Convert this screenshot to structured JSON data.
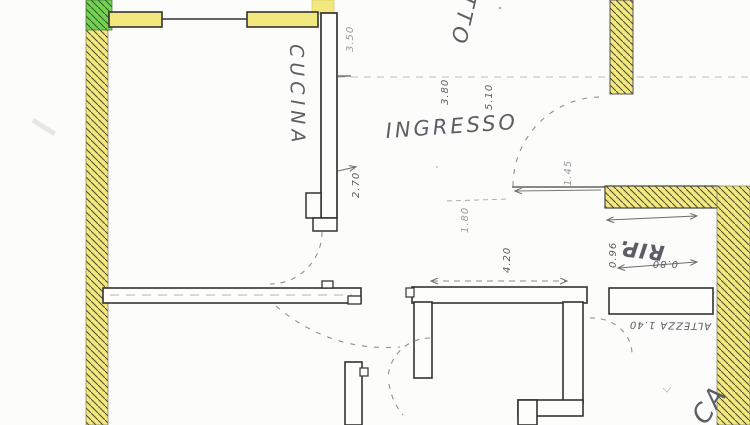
{
  "document": {
    "type": "scanned floor plan",
    "language": "it"
  },
  "colors": {
    "paper": "#fcfcfa",
    "wall_yellow": "#f2e87e",
    "wall_green": "#74d152",
    "ink": "#333333",
    "pencil": "#5d5d66",
    "pencil_faint": "#9b9ba2"
  },
  "rooms": {
    "kitchen": {
      "label": "CUCINA"
    },
    "hall": {
      "label": "INGRESSO"
    },
    "storage": {
      "label": "RIP."
    },
    "living_partial": {
      "label": "TTO"
    },
    "bedroom_partial": {
      "label": "CA"
    }
  },
  "dimensions": {
    "d380": "3.80",
    "d510": "5.10",
    "d350": "3.50",
    "d270": "2.70",
    "d180": "1.80",
    "d420": "4.20",
    "d145": "1.45",
    "d096": "0.96",
    "d080": "0.80",
    "height_note": "ALTEZZA 1.40"
  }
}
